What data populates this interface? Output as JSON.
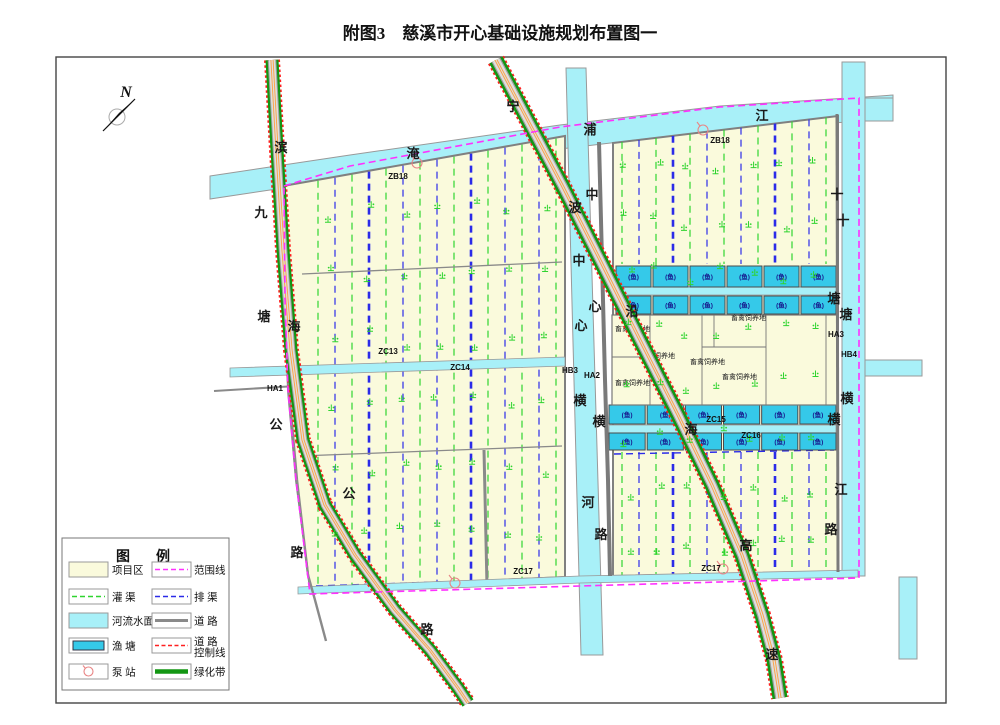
{
  "title": "附图3　慈溪市开心基础设施规划布置图一",
  "north": {
    "label": "N"
  },
  "colors": {
    "project": "#FAFADC",
    "river": "#A8F0F8",
    "pond": "#35C9E9",
    "irrigation": "#2FD42F",
    "drain": "#2B2BE8",
    "boundary": "#FF30FF",
    "control": "#FF2020",
    "road_gray": "#8C8C8C",
    "road_surface": "#DEDEDE",
    "greenbelt": "#129612",
    "center_line": "#FFA040",
    "bank": "#999999",
    "pump": "#E88585"
  },
  "labels": {
    "chars": [
      [
        "滨",
        281,
        152
      ],
      [
        "海",
        294,
        331
      ],
      [
        "公",
        349,
        498
      ],
      [
        "路",
        427,
        634
      ],
      [
        "九",
        261,
        217
      ],
      [
        "塘",
        264,
        321
      ],
      [
        "公",
        276,
        429
      ],
      [
        "路",
        297,
        557
      ],
      [
        "宁",
        513,
        111
      ],
      [
        "波",
        575,
        212
      ],
      [
        "沿",
        632,
        316
      ],
      [
        "海",
        691,
        434
      ],
      [
        "高",
        746,
        550
      ],
      [
        "速",
        772,
        659
      ],
      [
        "中",
        579,
        265
      ],
      [
        "心",
        581,
        330
      ],
      [
        "横",
        580,
        405
      ],
      [
        "河",
        588,
        507
      ],
      [
        "中",
        592,
        199
      ],
      [
        "心",
        595,
        311
      ],
      [
        "横",
        599,
        426
      ],
      [
        "路",
        601,
        539
      ],
      [
        "淹",
        413,
        158
      ],
      [
        "浦",
        590,
        134
      ],
      [
        "江",
        762,
        120
      ],
      [
        "十",
        843,
        225
      ],
      [
        "塘",
        846,
        319
      ],
      [
        "横",
        847,
        403
      ],
      [
        "江",
        841,
        494
      ],
      [
        "十",
        837,
        199
      ],
      [
        "塘",
        834,
        303
      ],
      [
        "横",
        834,
        424
      ],
      [
        "路",
        831,
        534
      ]
    ],
    "codes": [
      [
        "ZB18",
        398,
        179
      ],
      [
        "ZB18",
        720,
        143
      ],
      [
        "ZC13",
        388,
        354
      ],
      [
        "ZC14",
        460,
        370
      ],
      [
        "ZC15",
        716,
        422
      ],
      [
        "ZC16",
        751,
        438
      ],
      [
        "ZC17",
        523,
        574
      ],
      [
        "ZC17",
        711,
        571
      ],
      [
        "HA1",
        275,
        391
      ],
      [
        "HA2",
        592,
        378
      ],
      [
        "HB3",
        570,
        373
      ],
      [
        "HA3",
        836,
        337
      ],
      [
        "HB4",
        849,
        357
      ]
    ],
    "pond": "(鱼)",
    "livestock": {
      "text": "畜禽饲养地",
      "pos": [
        [
          615,
          331
        ],
        [
          731,
          320
        ],
        [
          640,
          358
        ],
        [
          690,
          364
        ],
        [
          722,
          379
        ],
        [
          615,
          385
        ]
      ]
    }
  },
  "pond_rows": [
    {
      "y": 266,
      "h": 21,
      "x0": 616,
      "x1": 836,
      "n": 6
    },
    {
      "y": 296,
      "h": 18,
      "x0": 616,
      "x1": 836,
      "n": 6
    },
    {
      "y": 405,
      "h": 19,
      "x0": 609,
      "x1": 836,
      "n": 6
    },
    {
      "y": 433,
      "h": 17,
      "x0": 609,
      "x1": 836,
      "n": 6
    }
  ],
  "legend": {
    "title": "图　例",
    "items": [
      {
        "type": "area-project",
        "label": "项目区"
      },
      {
        "type": "line-boundary",
        "label": "范围线"
      },
      {
        "type": "line-irrigation",
        "label": "灌  渠"
      },
      {
        "type": "line-drain",
        "label": "排  渠"
      },
      {
        "type": "area-river",
        "label": "河流水面"
      },
      {
        "type": "line-road",
        "label": "道  路"
      },
      {
        "type": "area-pond",
        "label": "渔  塘"
      },
      {
        "type": "line-control",
        "label": "道  路",
        "label2": "控制线"
      },
      {
        "type": "pump",
        "label": "泵  站"
      },
      {
        "type": "line-greenbelt",
        "label": "绿化带"
      }
    ]
  }
}
